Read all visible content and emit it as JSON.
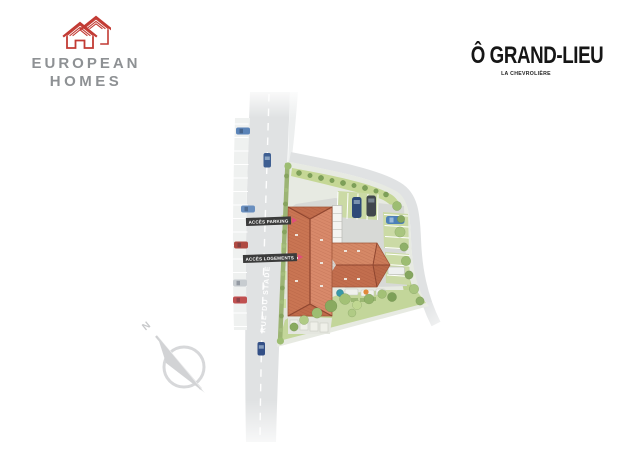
{
  "branding": {
    "logo": {
      "line1": "EUROPEAN",
      "line2": "HOMES",
      "icon": "house-icon",
      "icon_color": "#c23a33",
      "text_color": "#8e9194"
    }
  },
  "header": {
    "title": "Ô GRAND-LIEU",
    "subtitle": "LA CHEVROLIÈRE",
    "title_color": "#161616"
  },
  "plan": {
    "street_label": "RUE DU STADE",
    "access_labels": [
      {
        "label": "ACCÈS PARKING",
        "arrow_direction": "right"
      },
      {
        "label": "ACCÈS LOGEMENTS",
        "arrow_direction": "right"
      }
    ],
    "compass": {
      "label": "N"
    },
    "colors": {
      "road": "#e0e2e3",
      "roof": "#cf805f",
      "roof_ridge": "#8f4630",
      "lawn": "#c5d795",
      "grass_pavers": "#cbdaa5",
      "hedge": "#9cb474",
      "label_background": "#3b3b3b",
      "label_text": "#ffffff",
      "arrow_pink": "#e0507c",
      "compass_gray": "#d2d3d5"
    }
  }
}
